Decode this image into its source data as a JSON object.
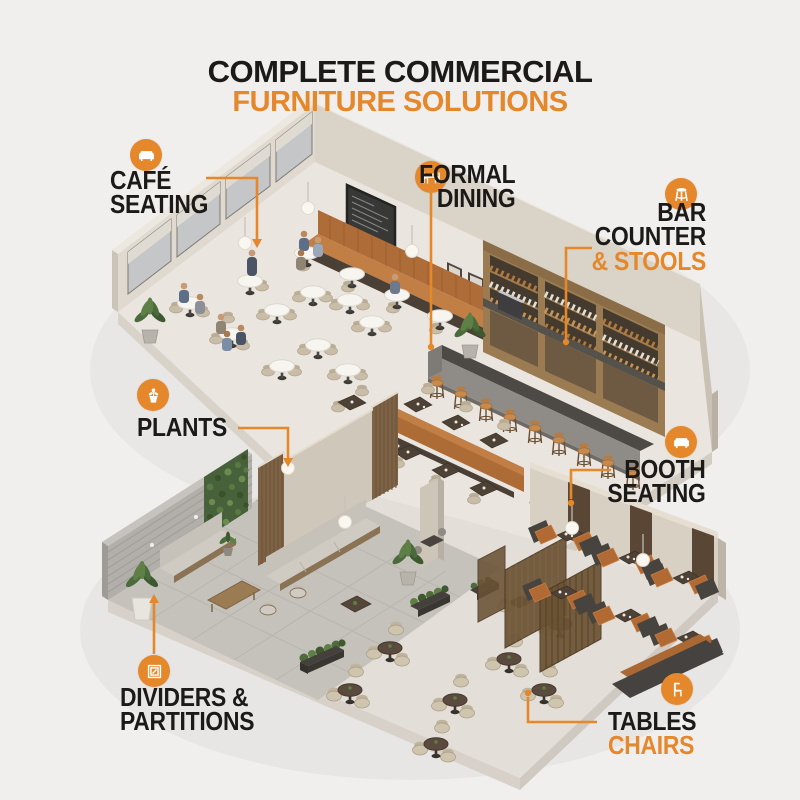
{
  "title": {
    "line1": "COMPLETE COMMERCIAL",
    "line2": "FURNITURE SOLUTIONS"
  },
  "colors": {
    "accent": "#E5872B",
    "ink": "#1B1A18",
    "background": "#F0EFED"
  },
  "callouts": {
    "cafe_seating": {
      "icon": "sofa-icon",
      "line1": "CAFÉ",
      "line2": "SEATING"
    },
    "formal_dining": {
      "icon": "dining-table-icon",
      "line1": "FORMAL",
      "line2": "DINING"
    },
    "bar_counter": {
      "icon": "bar-stool-icon",
      "line1": "BAR",
      "line2": "COUNTER",
      "line3": "& STOOLS"
    },
    "plants": {
      "icon": "potted-plant-icon",
      "line1": "PLANTS"
    },
    "booth_seating": {
      "icon": "sofa-icon",
      "line1": "BOOTH",
      "line2": "SEATING"
    },
    "dividers_partitions": {
      "icon": "divider-panel-icon",
      "line1": "DIVIDERS &",
      "line2": "PARTITIONS"
    },
    "tables_chairs": {
      "icon": "chair-icon",
      "line1": "TABLES",
      "line2": "CHAIRS"
    }
  },
  "scene": {
    "description": "Isometric 3D render of a two-level commercial restaurant interior",
    "areas": [
      "café seating",
      "formal dining",
      "bar counter & stools",
      "plants",
      "booth seating",
      "dividers & partitions",
      "tables & chairs",
      "lounge"
    ]
  }
}
